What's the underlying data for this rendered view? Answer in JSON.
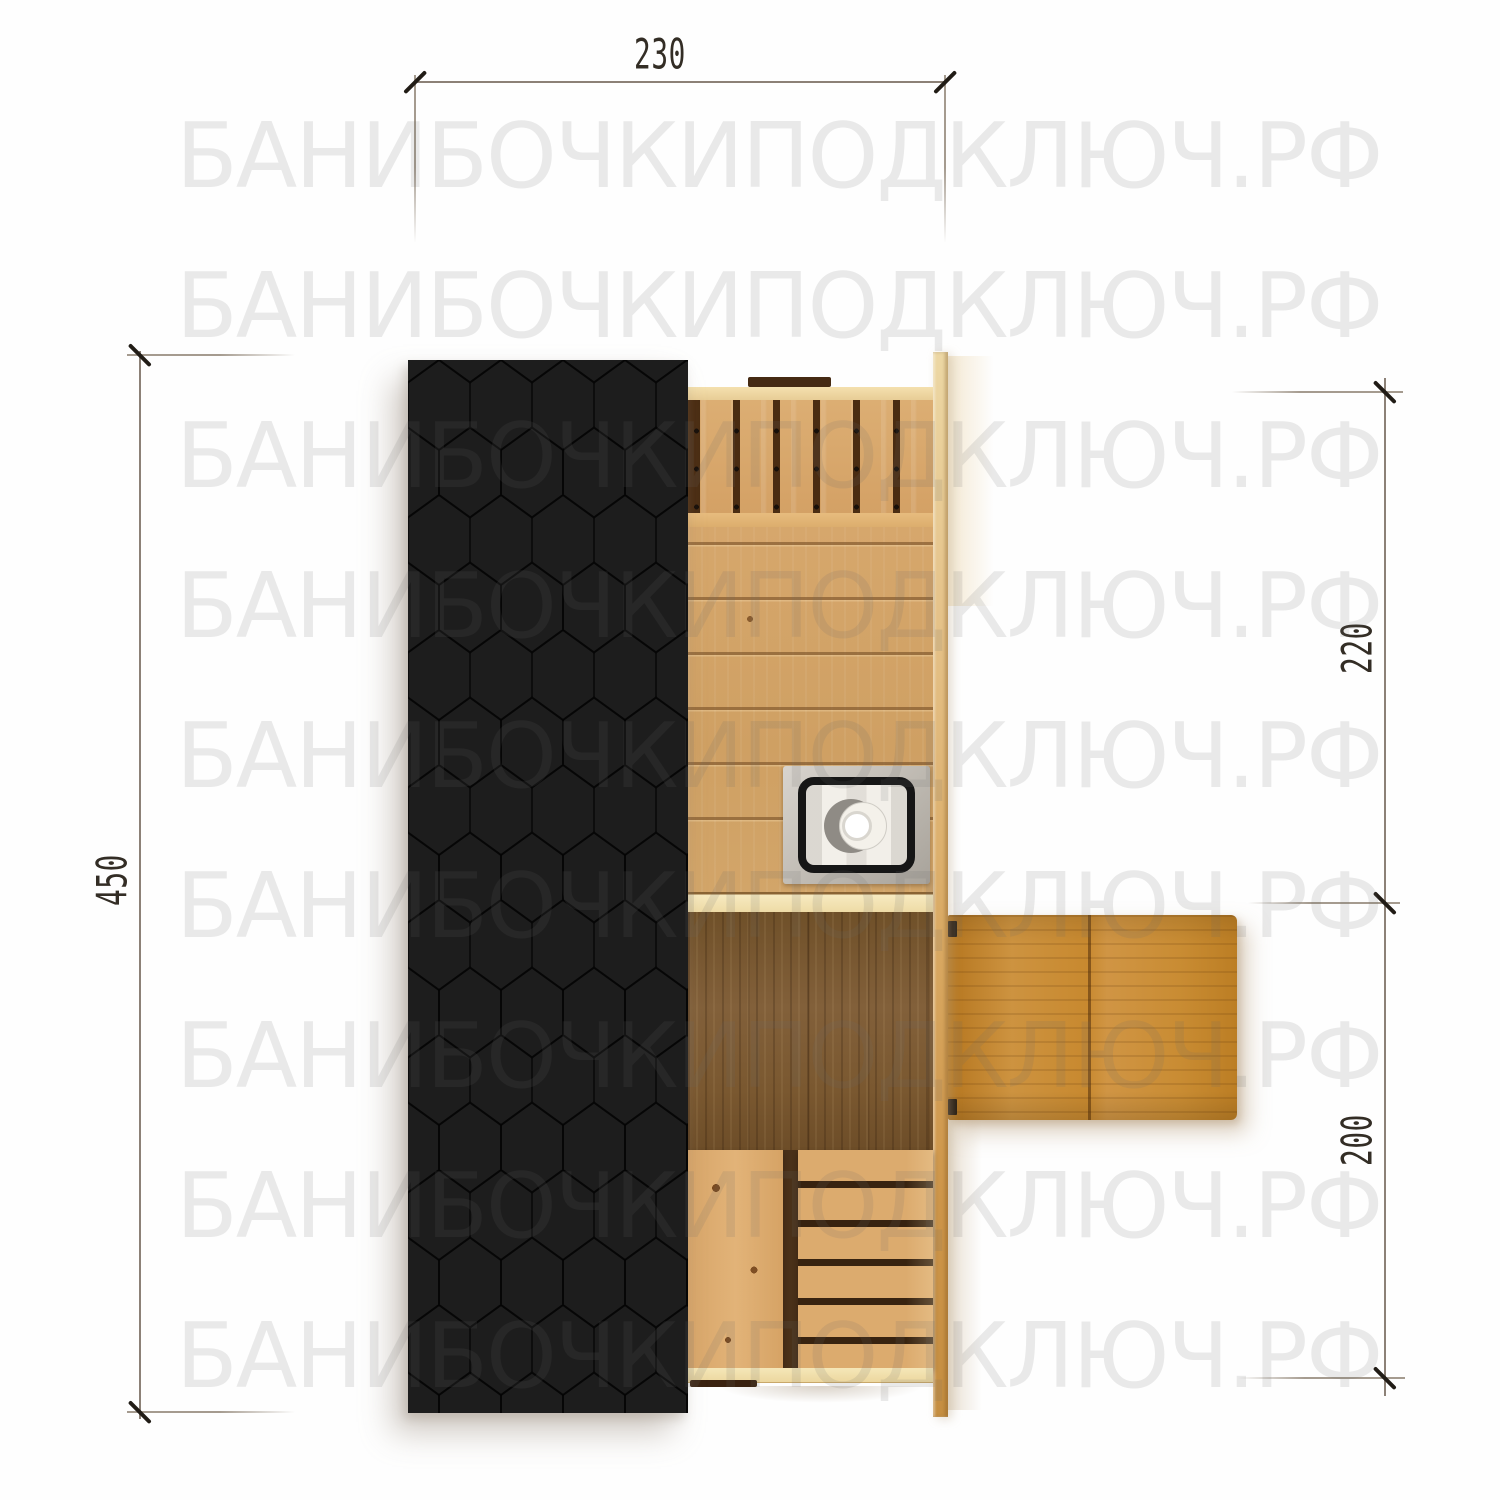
{
  "watermark": {
    "text": "БАНИБОЧКИПОДКЛЮЧ.РФ"
  },
  "dimensions": {
    "top_width": "230",
    "left_height": "450",
    "right_upper": "220",
    "right_lower": "200"
  },
  "colors": {
    "roof_shingles": "#1d1d1d",
    "wood_light_pine": "#d9a96e",
    "entrance_floor_dark": "#7d5b33",
    "terrace_platform": "#c98c33",
    "wall_cream": "#f0dca8",
    "stove_metal": "#c4bfb8",
    "dimension_line": "#8c8177",
    "dimension_text": "#332d25",
    "watermark_gray": "#e9e9e9",
    "background": "#fefefe"
  }
}
